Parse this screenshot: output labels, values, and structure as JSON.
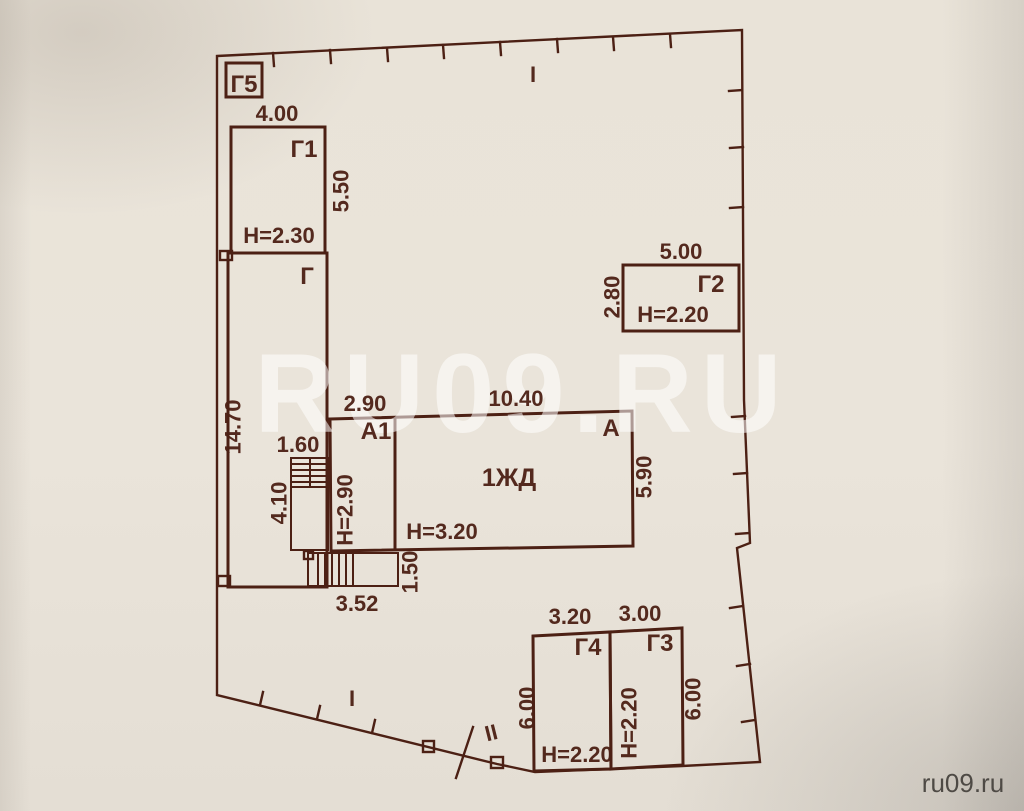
{
  "colors": {
    "ink": "#4c2014",
    "paper": "#e9e3d8",
    "watermark": "rgba(255,255,255,0.55)",
    "corner": "#4e4a45"
  },
  "watermark": {
    "large": "RU09.RU",
    "corner": "ru09.ru"
  },
  "boundary_marks": {
    "section_top": "I",
    "section_bottom": "I",
    "section_second": "II"
  },
  "buildings": {
    "g5": {
      "label": "Г5"
    },
    "g1": {
      "label": "Г1",
      "width": "4.00",
      "depth": "5.50",
      "height": "Н=2.30"
    },
    "g": {
      "label": "Г",
      "length": "14.70"
    },
    "g2": {
      "label": "Г2",
      "width": "5.00",
      "depth": "2.80",
      "height": "Н=2.20"
    },
    "a": {
      "label": "А",
      "use": "1ЖД",
      "width": "10.40",
      "depth": "5.90",
      "height": "Н=3.20"
    },
    "a1": {
      "label": "А1",
      "width": "2.90",
      "height": "Н=2.90"
    },
    "stairs": {
      "width": "1.60",
      "depth": "4.10"
    },
    "porch": {
      "width": "3.52",
      "depth": "1.50"
    },
    "g4": {
      "label": "Г4",
      "width": "3.20",
      "depth": "6.00",
      "height": "Н=2.20"
    },
    "g3": {
      "label": "Г3",
      "width": "3.00",
      "depth": "6.00",
      "height": "Н=2.20"
    }
  }
}
